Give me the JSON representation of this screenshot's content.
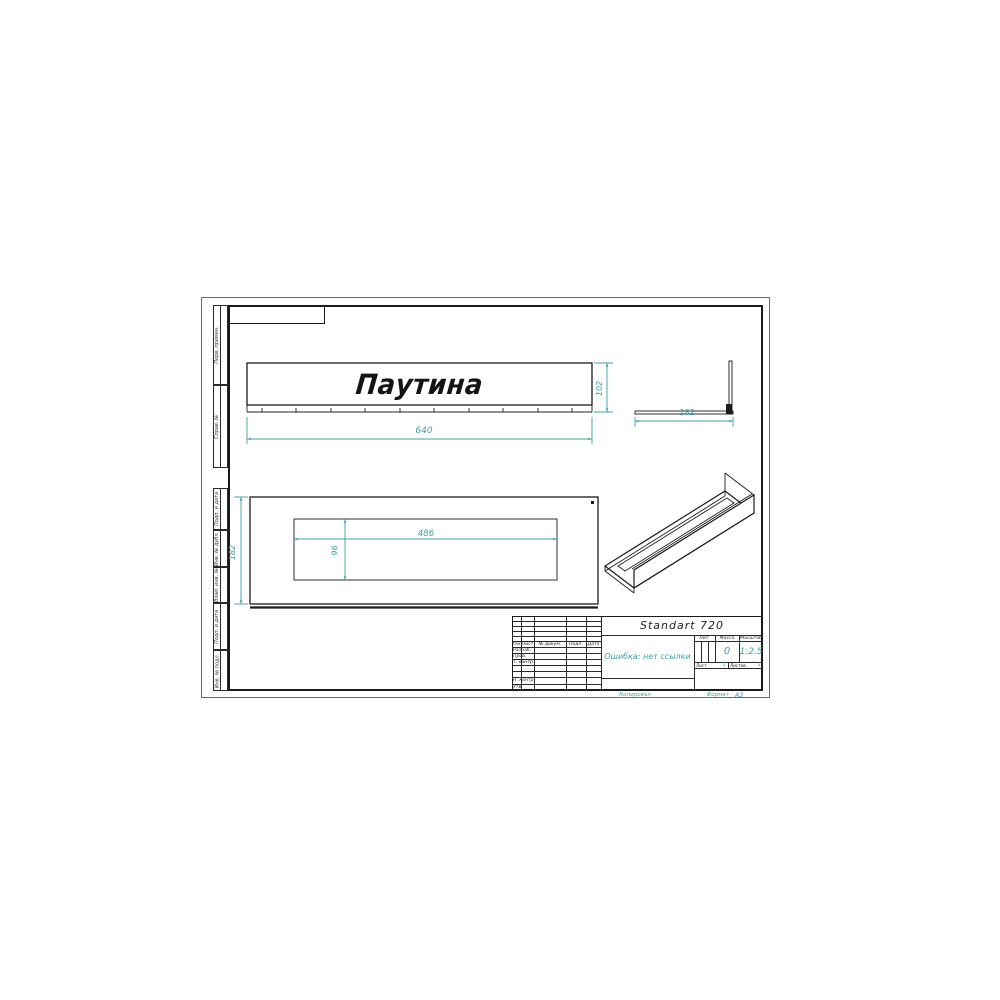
{
  "drawing": {
    "logo": "Паутина",
    "dimensions": {
      "length": "640",
      "height": "102",
      "depth_side": "182",
      "slot_length": "486",
      "slot_width": "96",
      "depth_plan": "182"
    }
  },
  "left_margin": {
    "top_cells": [
      "Перв. примен.",
      "Справ. №"
    ],
    "bottom_cells": [
      "Подп. и дата",
      "Инв. № дубл.",
      "Взам. инв. №",
      "Подп. и дата",
      "Инв. № подл."
    ]
  },
  "title_block": {
    "designation": "Standart 720",
    "part_name": "Ошибка: нет ссылки",
    "change_header": [
      "Изм.",
      "Лист",
      "№ докум.",
      "Подп.",
      "Дата"
    ],
    "signature_rows": [
      "Разраб.",
      "Пров.",
      "Т. контр.",
      "Н. контр.",
      "Утв."
    ],
    "lit_label": "Лит.",
    "mass_label": "Масса",
    "scale_label": "Масштаб",
    "mass_value": "0",
    "scale_value": "1:2.5",
    "sheet_label": "Лист",
    "sheets_label": "Листов",
    "sheet_value": "1",
    "sheets_value": "1"
  },
  "footer": {
    "copied_label": "Копировал",
    "format_label": "Формат",
    "format_value": "A3"
  },
  "colors": {
    "dimension": "#3f9fa6",
    "line": "#1c1c1c"
  }
}
